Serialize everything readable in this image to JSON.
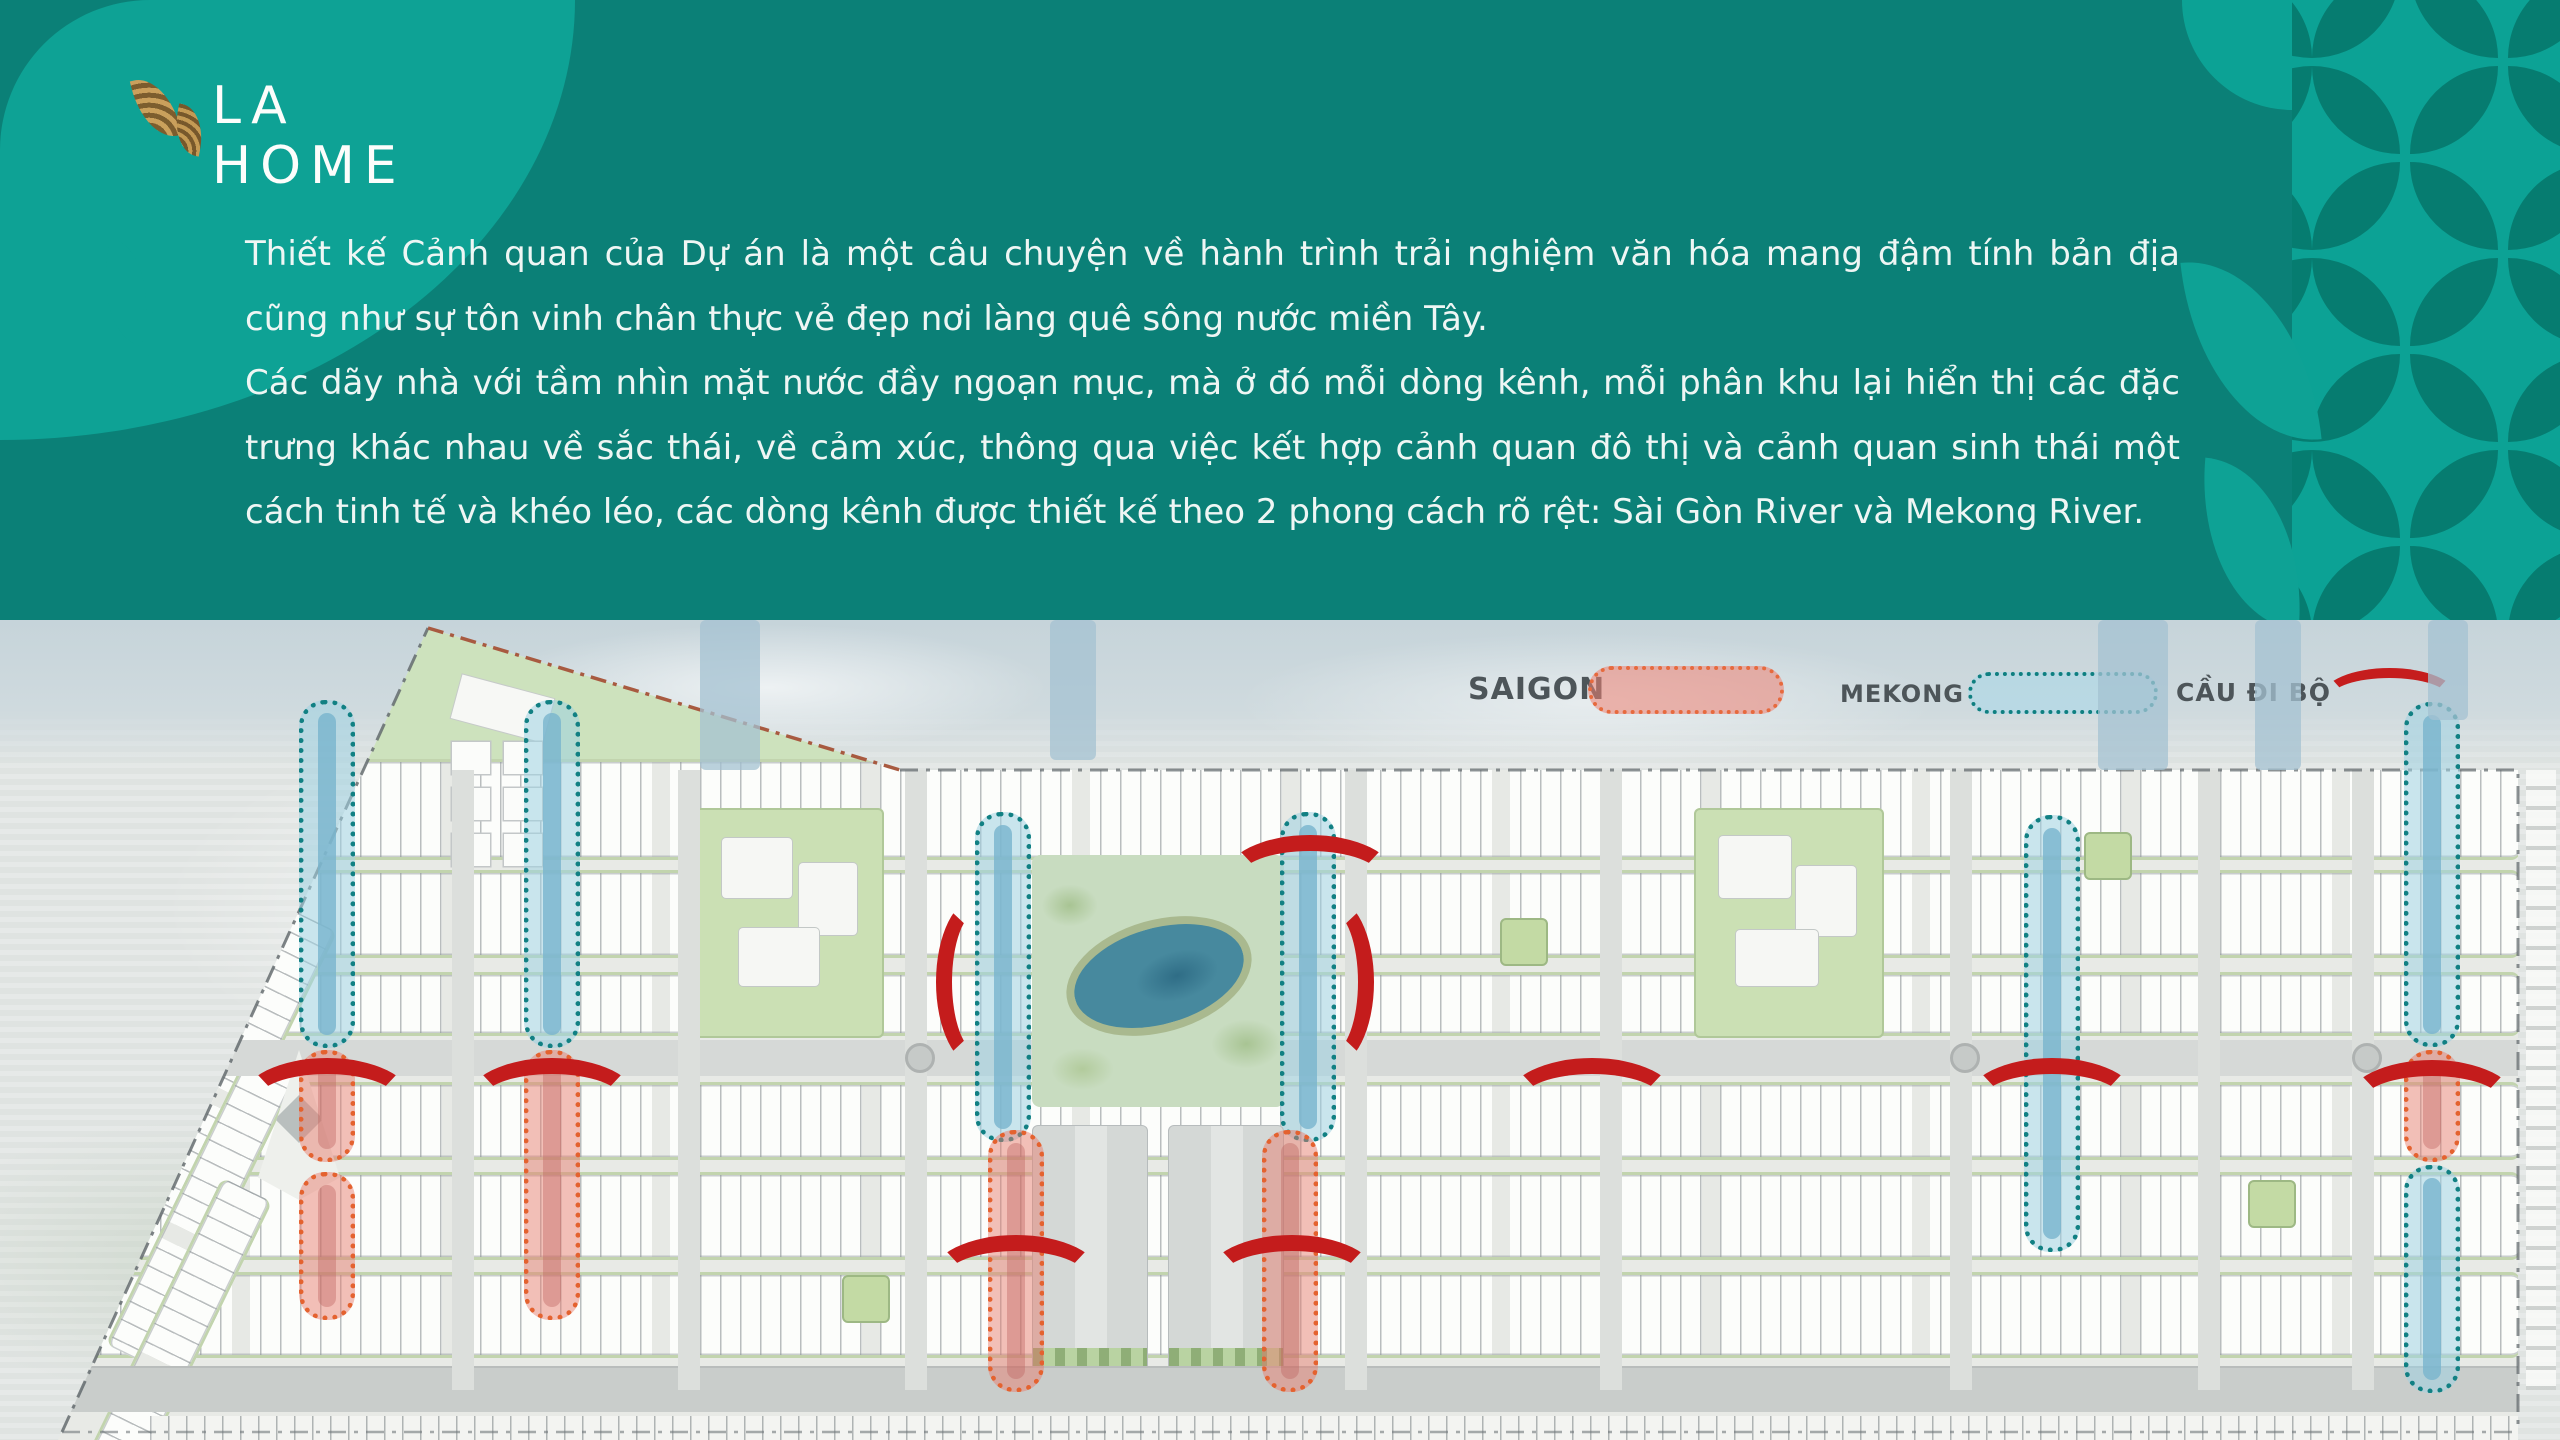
{
  "logo": {
    "brand": "LA HOME"
  },
  "intro": {
    "paragraph1": "Thiết kế Cảnh quan của Dự án là một câu chuyện về hành trình trải nghiệm văn hóa mang đậm tính bản địa cũng như sự tôn vinh chân thực vẻ đẹp nơi làng quê sông nước miền Tây.",
    "paragraph2": "Các dãy nhà với tầm nhìn mặt nước đầy ngoạn mục, mà ở đó mỗi dòng kênh, mỗi phân khu lại hiển thị các đặc trưng khác nhau về sắc thái, về cảm xúc, thông qua việc kết hợp cảnh quan đô thị và cảnh quan sinh thái một cách tinh tế và khéo léo, các dòng kênh được thiết kế theo 2 phong cách rõ rệt: Sài Gòn River và Mekong River."
  },
  "legend": {
    "saigon_label": "SAIGON",
    "mekong_label": "MEKONG",
    "bridge_label": "CẦU ĐI BỘ"
  },
  "colors": {
    "teal_dark": "#0b8077",
    "teal_light": "#0ca295",
    "leaf_dark": "#067c70",
    "logo_gold": "#b08948",
    "saigon_canal": "#e4622f",
    "mekong_canal": "#118083",
    "bridge_red": "#c41c1c"
  },
  "map": {
    "canals": [
      {
        "type": "mekong",
        "x": 327,
        "y": 80,
        "h": 348
      },
      {
        "type": "mekong",
        "x": 552,
        "y": 80,
        "h": 348
      },
      {
        "type": "mekong",
        "x": 1003,
        "y": 192,
        "h": 330
      },
      {
        "type": "mekong",
        "x": 1308,
        "y": 192,
        "h": 330
      },
      {
        "type": "mekong",
        "x": 2052,
        "y": 195,
        "h": 437
      },
      {
        "type": "mekong",
        "x": 2432,
        "y": 82,
        "h": 345
      },
      {
        "type": "mekong",
        "x": 2432,
        "y": 545,
        "h": 228
      },
      {
        "type": "saigon",
        "x": 327,
        "y": 430,
        "h": 112
      },
      {
        "type": "saigon",
        "x": 327,
        "y": 552,
        "h": 148
      },
      {
        "type": "saigon",
        "x": 552,
        "y": 430,
        "h": 270
      },
      {
        "type": "saigon",
        "x": 1016,
        "y": 510,
        "h": 262
      },
      {
        "type": "saigon",
        "x": 1290,
        "y": 510,
        "h": 262
      },
      {
        "type": "saigon",
        "x": 2432,
        "y": 430,
        "h": 112
      }
    ],
    "bridges": [
      {
        "x": 327,
        "y": 438,
        "r": 0
      },
      {
        "x": 552,
        "y": 438,
        "r": 0
      },
      {
        "x": 978,
        "y": 320,
        "r": -90
      },
      {
        "x": 1332,
        "y": 320,
        "r": 90
      },
      {
        "x": 1310,
        "y": 215,
        "r": 0
      },
      {
        "x": 1016,
        "y": 615,
        "r": 0
      },
      {
        "x": 1292,
        "y": 615,
        "r": 0
      },
      {
        "x": 1592,
        "y": 438,
        "r": 0
      },
      {
        "x": 2052,
        "y": 438,
        "r": 0
      },
      {
        "x": 2432,
        "y": 440,
        "r": 0
      }
    ]
  }
}
